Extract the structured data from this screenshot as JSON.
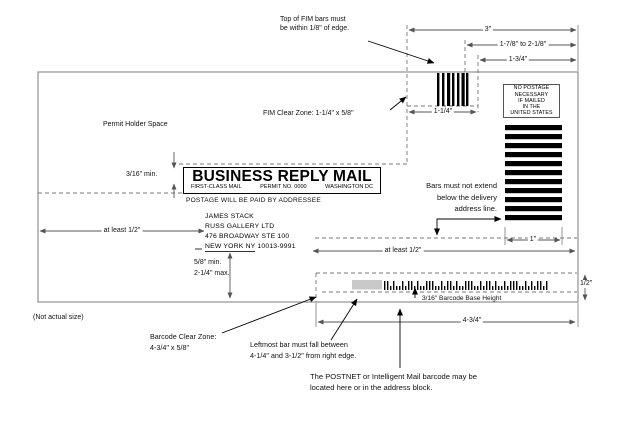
{
  "diagram": {
    "caption": "(Not actual size)",
    "envelope": {
      "permit_holder_space": "Permit Holder Space",
      "brm": {
        "title": "BUSINESS REPLY MAIL",
        "mail_class": "FIRST-CLASS MAIL",
        "permit": "PERMIT NO. 0000",
        "city": "WASHINGTON DC",
        "postage_line": "POSTAGE WILL BE PAID BY ADDRESSEE"
      },
      "address": {
        "line1": "JAMES STACK",
        "line2": "RUSS GALLERY LTD",
        "line3": "476 BROADWAY STE 100",
        "city": "NEW YORK NY",
        "zip": " 10013-9991"
      },
      "no_postage": {
        "l1": "NO POSTAGE",
        "l2": "NECESSARY",
        "l3": "IF MAILED",
        "l4": "IN THE",
        "l5": "UNITED STATES"
      }
    },
    "dimensions": {
      "top_3": "3\"",
      "top_range": "1-7/8\" to 2-1/8\"",
      "top_134": "1-3/4\"",
      "fim_width": "1-1/4\"",
      "brm_gap": "3/16\" min.",
      "left_clearance": "at least 1/2\"",
      "mid_clearance": "at least 1/2\"",
      "addr_min": "5/8\" min.",
      "addr_max": "2-1/4\" max.",
      "bars_width": "1\"",
      "right_half": "1/2\"",
      "bottom_434": "4-3/4\""
    },
    "annotations": {
      "fim_top_1": "Top of FIM bars must",
      "fim_top_2": "be within 1/8\" of edge.",
      "fim_clear_zone": "FIM Clear Zone: 1-1/4\" x 5/8\"",
      "bars_1": "Bars must not extend",
      "bars_2": "below the delivery",
      "bars_3": "address line.",
      "barcode_base": "3/16\" Barcode Base Height",
      "bcz_1": "Barcode Clear Zone:",
      "bcz_2": "4-3/4\" x 5/8\"",
      "leftmost_1": "Leftmost bar must fall between",
      "leftmost_2": "4-1/4\" and 3-1/2\" from right edge.",
      "postnet_1": "The POSTNET or Intelligent Mail barcode may be",
      "postnet_2": "located here or in the address block."
    }
  }
}
